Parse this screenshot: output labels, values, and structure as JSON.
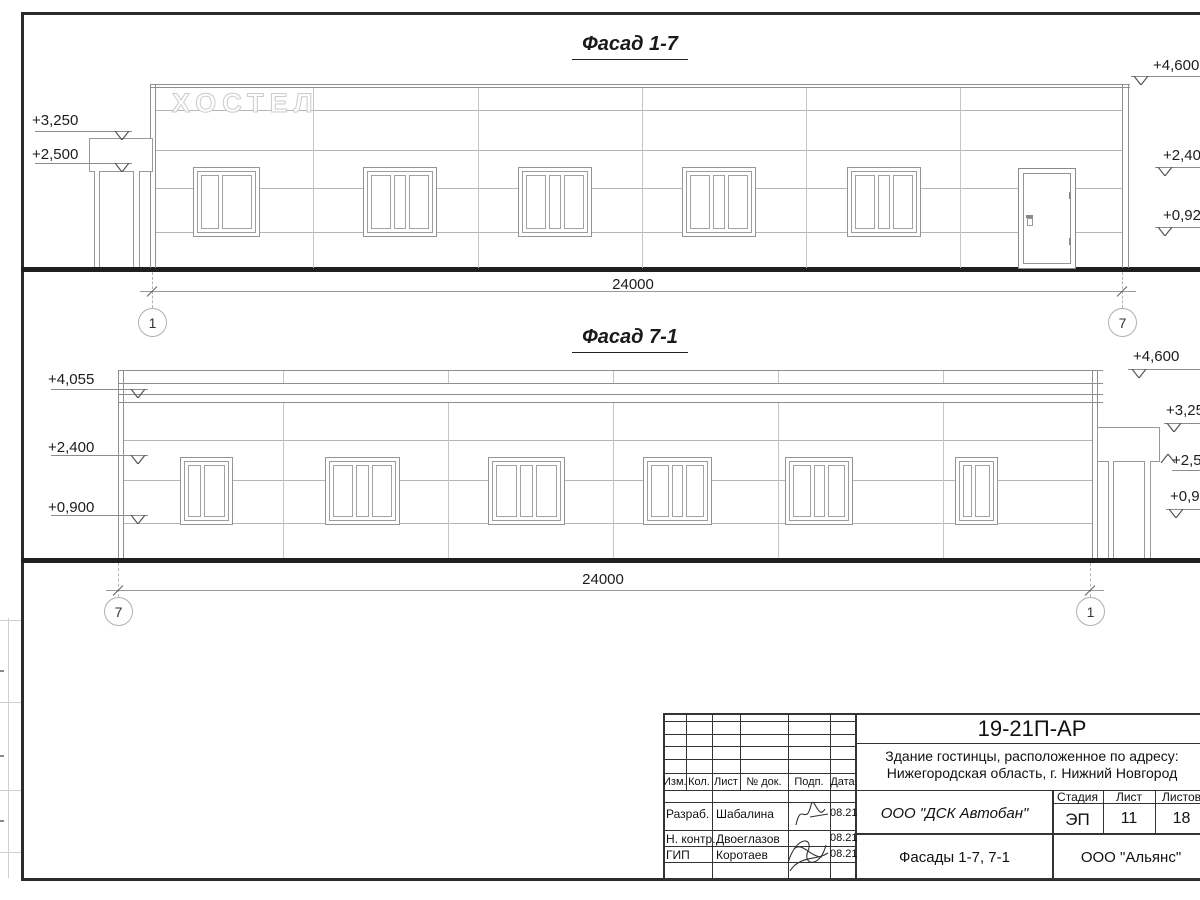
{
  "sheet": {
    "facade_1_7": {
      "title": "Фасад 1-7",
      "sign": "ХОСТЕЛ",
      "dimension": "24000",
      "axis_left": "1",
      "axis_right": "7",
      "marks_left": [
        {
          "text": "+3,250"
        },
        {
          "text": "+2,500"
        }
      ],
      "marks_right": [
        {
          "text": "+4,600"
        },
        {
          "text": "+2,400"
        },
        {
          "text": "+0,920"
        }
      ]
    },
    "facade_7_1": {
      "title": "Фасад 7-1",
      "dimension": "24000",
      "axis_left": "7",
      "axis_right": "1",
      "marks_left": [
        {
          "text": "+4,055"
        },
        {
          "text": "+2,400"
        },
        {
          "text": "+0,900"
        }
      ],
      "marks_right": [
        {
          "text": "+4,600"
        },
        {
          "text": "+3,250"
        },
        {
          "text": "+2,500"
        },
        {
          "text": "+0,920"
        }
      ]
    },
    "title_block": {
      "doc_code": "19-21П-АР",
      "object_address_line1": "Здание гостинцы, расположенное по адресу:",
      "object_address_line2": "Нижегородская область, г. Нижний Новгород",
      "organization": "ООО \"ДСК Автобан\"",
      "sheet_name": "Фасады 1-7, 7-1",
      "contractor": "ООО \"Альянс\"",
      "stage_label": "Стадия",
      "stage_value": "ЭП",
      "list_label": "Лист",
      "list_value": "11",
      "listov_label": "Листов",
      "listov_value": "18",
      "col_izm": "Изм.",
      "col_kol": "Кол.",
      "col_list": "Лист",
      "col_ndok": "№ док.",
      "col_podp": "Подп.",
      "col_data": "Дата",
      "signers": [
        {
          "role": "Разраб.",
          "name": "Шабалина",
          "date": "08.21"
        },
        {
          "role": "Н. контр.",
          "name": "Двоеглазов",
          "date": "08.21"
        },
        {
          "role": "ГИП",
          "name": "Коротаев",
          "date": "08.21"
        }
      ]
    }
  }
}
